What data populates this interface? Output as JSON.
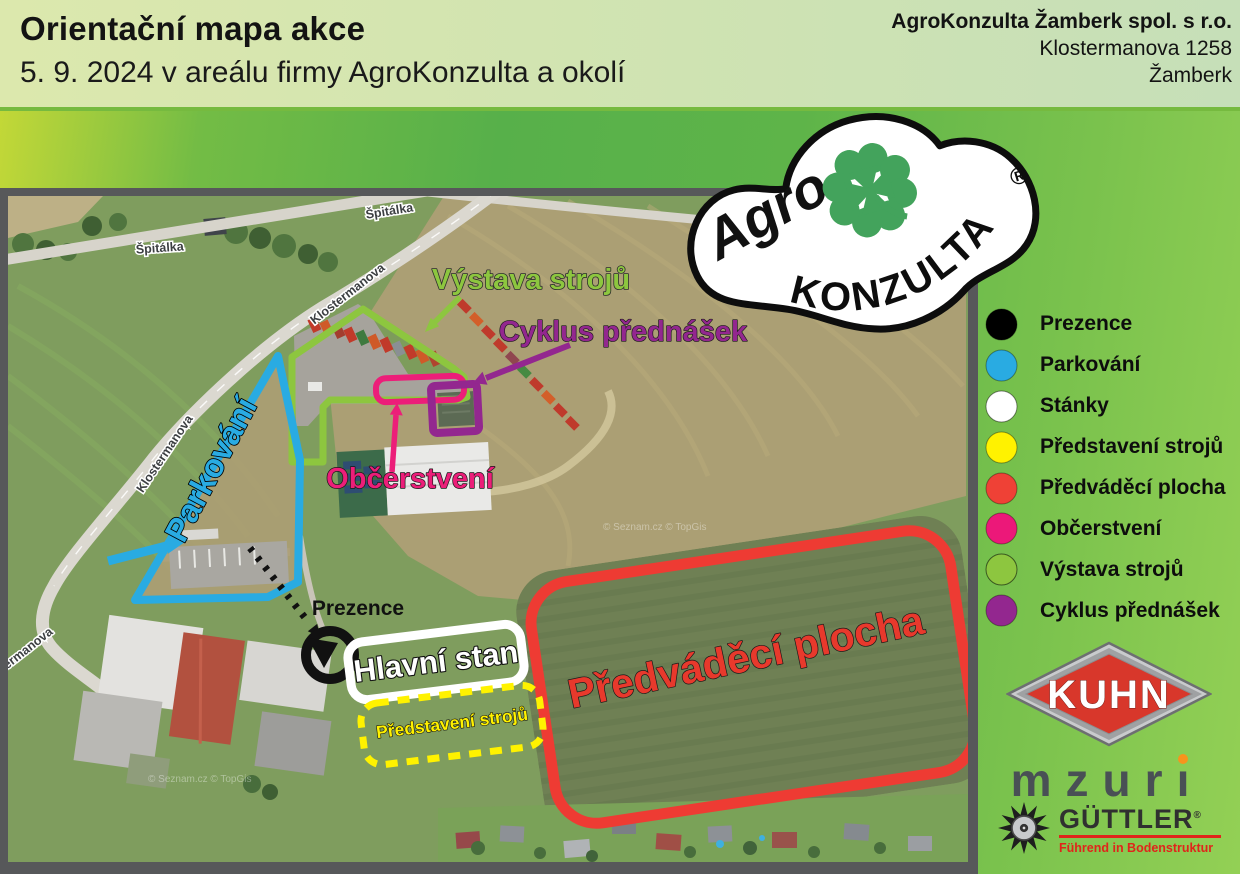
{
  "header": {
    "title": "Orientační mapa akce",
    "subtitle": "5. 9. 2024 v areálu firmy AgroKonzulta a okolí",
    "company_name": "AgroKonzulta Žamberk spol. s r.o.",
    "company_street": "Klostermanova 1258",
    "company_city": "Žamberk"
  },
  "map": {
    "streets": {
      "spitalka": "Špitálka",
      "klostermanova": "Klostermanova"
    },
    "labels": {
      "vystava_stroju": "Výstava strojů",
      "cyklus_prednasek": "Cyklus přednášek",
      "parkovani": "Parkování",
      "obcerstveni": "Občerstvení",
      "prezence": "Prezence",
      "hlavni_stan": "Hlavní stan",
      "predstaveni_stroju": "Představení strojů",
      "predvadeci_plocha": "Předváděcí plocha"
    },
    "watermark": "© Seznam.cz © TopGis"
  },
  "legend": {
    "items": [
      {
        "label": "Prezence",
        "color": "#000000"
      },
      {
        "label": "Parkování",
        "color": "#29abe2"
      },
      {
        "label": "Stánky",
        "color": "#ffffff"
      },
      {
        "label": "Představení strojů",
        "color": "#fff200"
      },
      {
        "label": "Předváděcí plocha",
        "color": "#ef4136"
      },
      {
        "label": "Občerstvení",
        "color": "#ec1879"
      },
      {
        "label": "Výstava strojů",
        "color": "#8dc63f"
      },
      {
        "label": "Cyklus přednášek",
        "color": "#93278f"
      }
    ]
  },
  "logos": {
    "agrokonzulta": {
      "script": "Agro",
      "arc": "KONZULTA",
      "registered": "®"
    },
    "kuhn": {
      "text": "KUHN"
    },
    "mzuri": {
      "stem": "mzur",
      "i_glyph": "ı"
    },
    "guttler": {
      "text": "GÜTTLER",
      "registered": "®",
      "tagline": "Führend in Bodenstruktur"
    }
  }
}
